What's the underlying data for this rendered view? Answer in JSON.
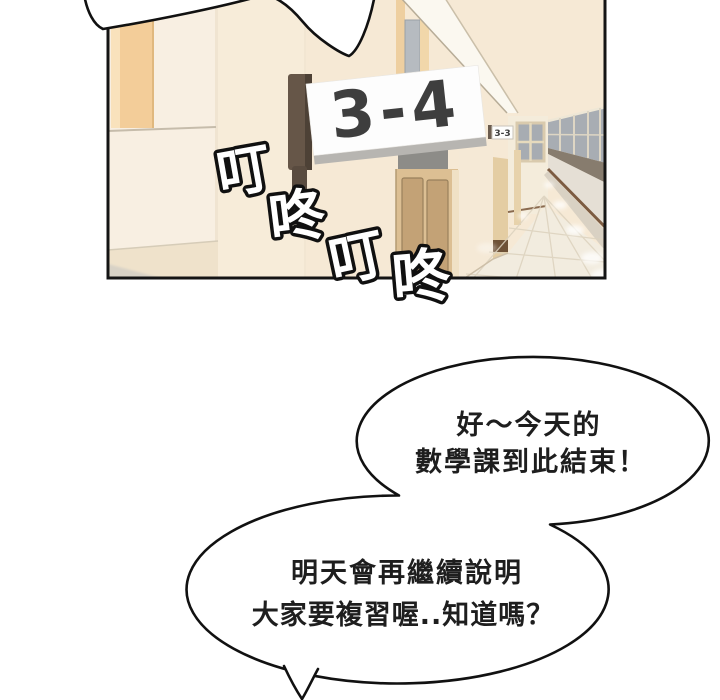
{
  "panel": {
    "sign": {
      "label": "3-4"
    },
    "far_sign": {
      "label": "3-3"
    },
    "colors": {
      "wall": "#f6e9d5",
      "wall_left": "#f8efe2",
      "poster": "#f3cd99",
      "sign_plate": "#fdfdfd",
      "sign_text": "#3e3e3e",
      "sign_bracket": "#665648",
      "door_wood": "#dcbf93",
      "window_pane": "#a8adb3",
      "locker_rail": "#7c5b41",
      "floor": "#f2ecdf",
      "border": "#141414"
    }
  },
  "sfx": {
    "chars": [
      "叮",
      "咚",
      "叮",
      "咚"
    ]
  },
  "bubbles": [
    {
      "lines": [
        "好～今天的",
        "數學課到此結束！"
      ]
    },
    {
      "lines": [
        "明天會再繼續說明",
        "大家要複習喔..知道嗎？"
      ]
    }
  ]
}
